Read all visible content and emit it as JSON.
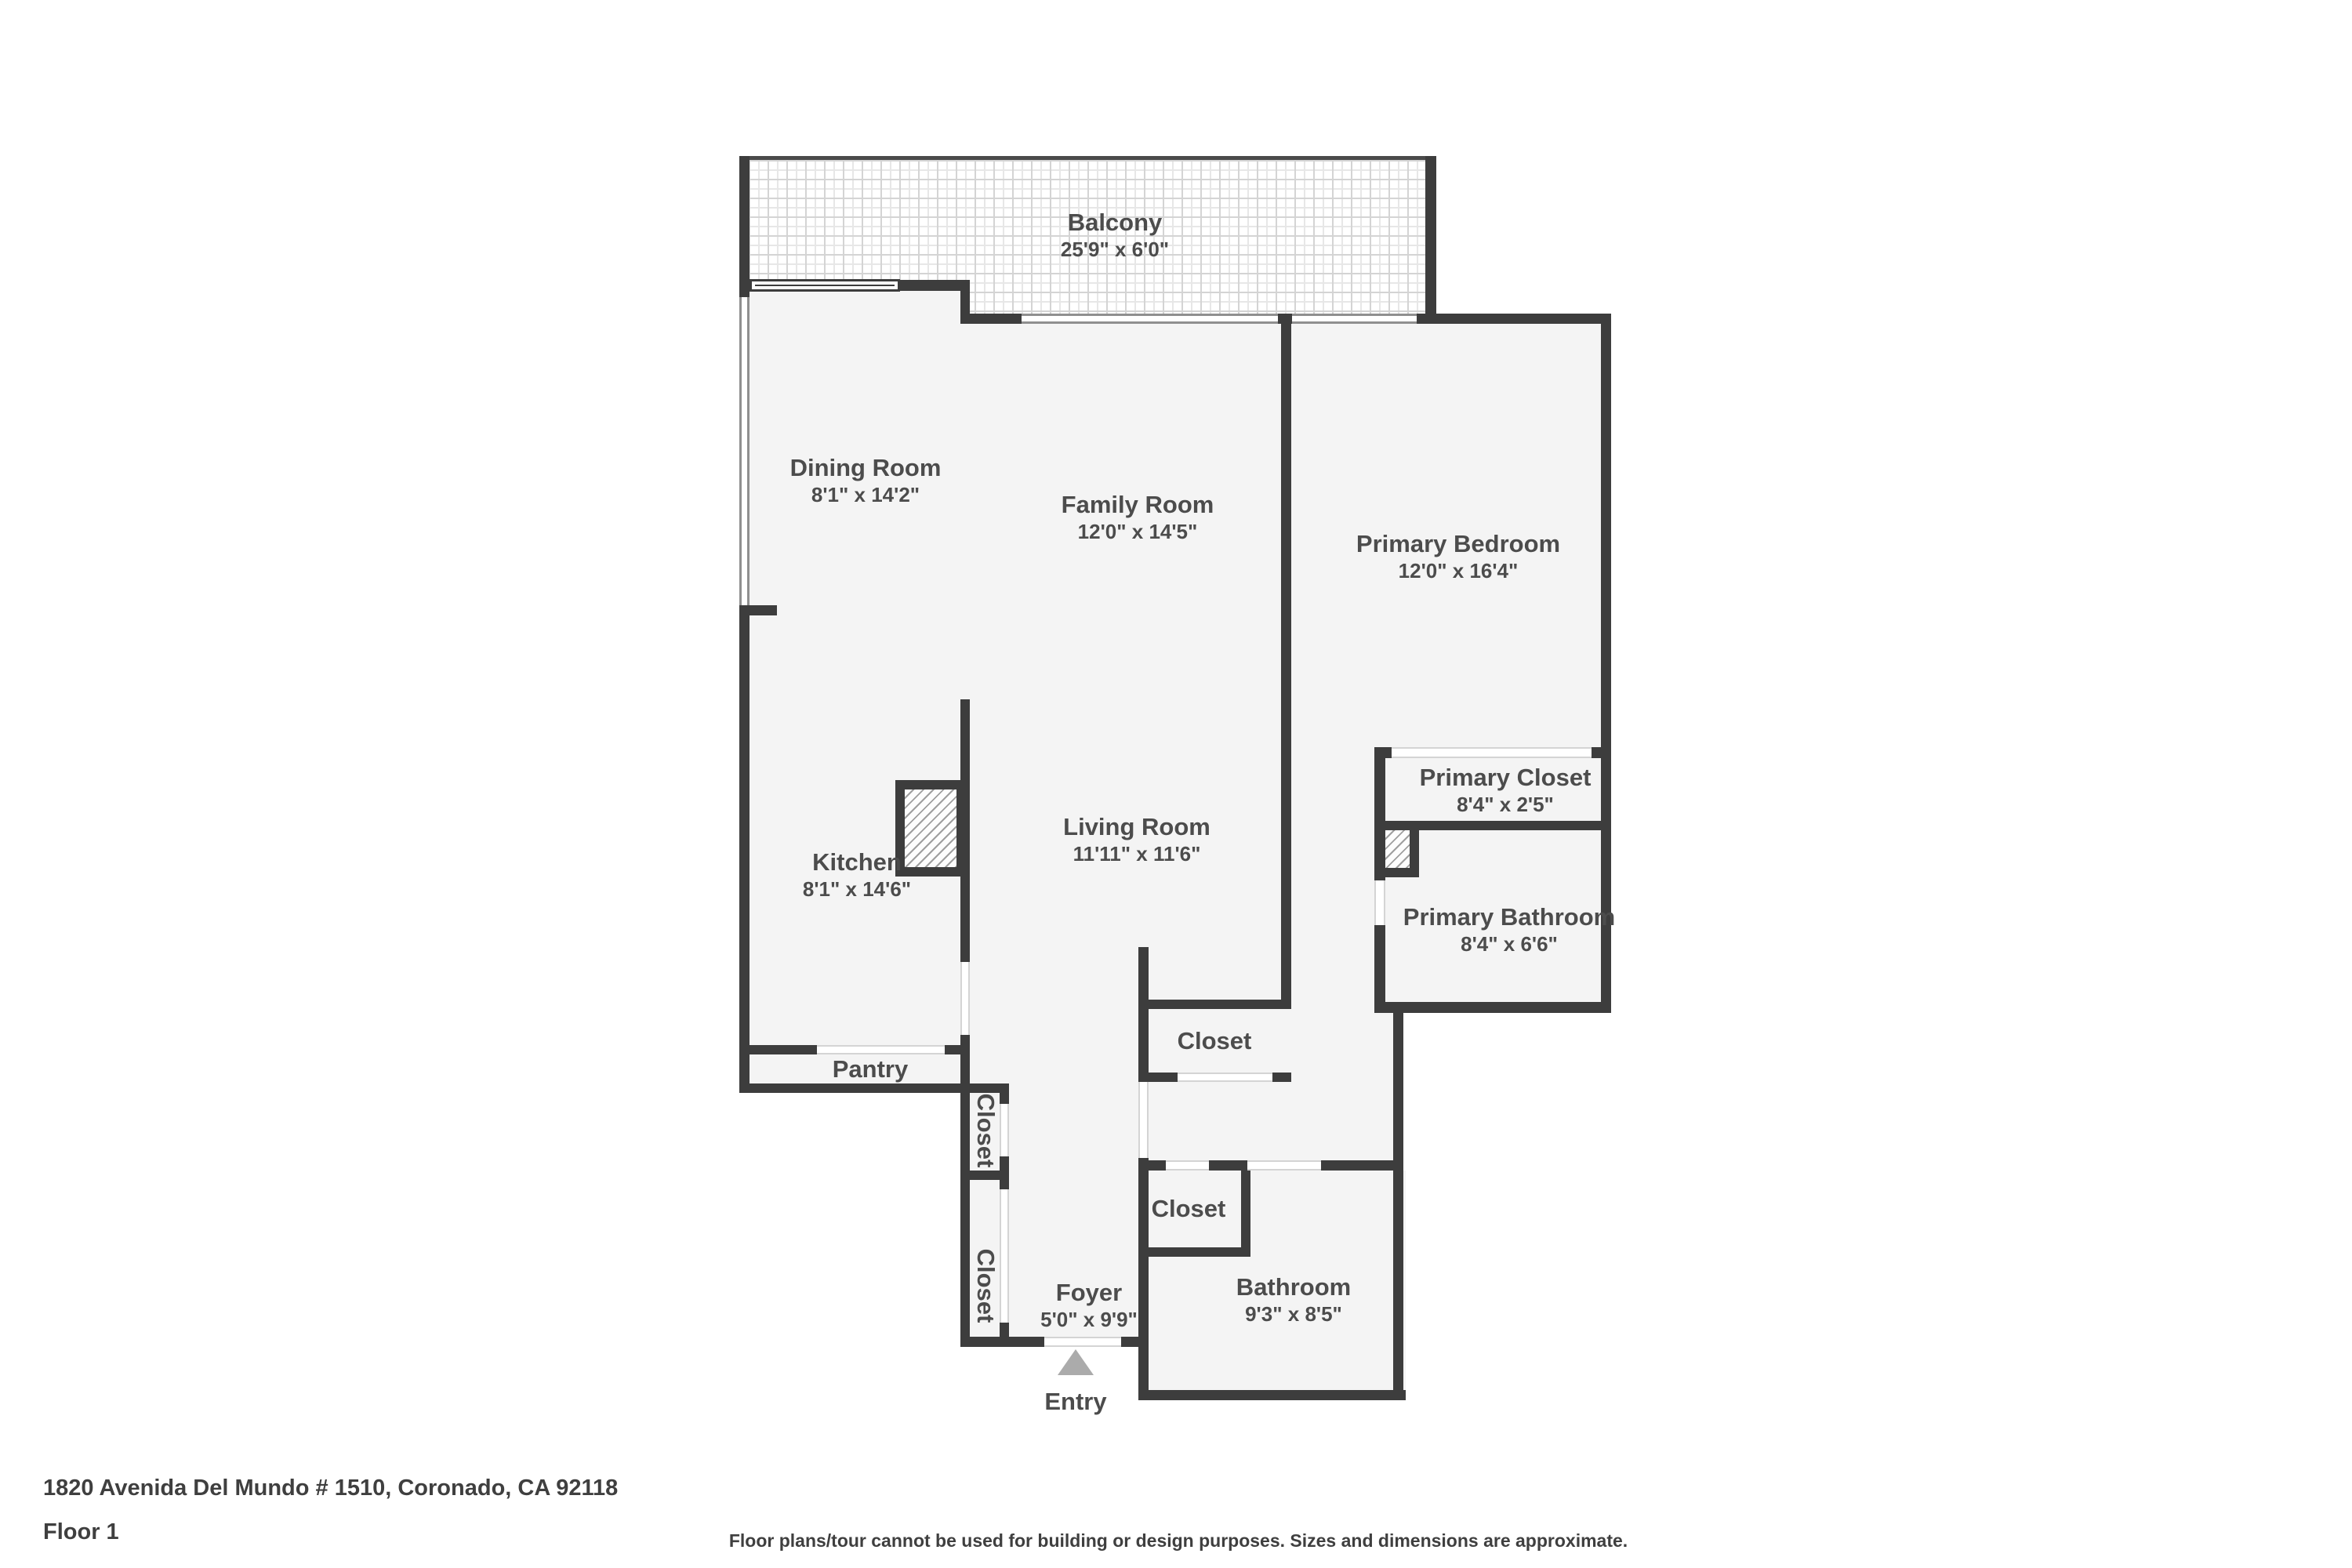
{
  "plan": {
    "rooms": {
      "balcony": {
        "name": "Balcony",
        "dims": "25'9\" x 6'0\""
      },
      "dining_room": {
        "name": "Dining Room",
        "dims": "8'1\" x 14'2\""
      },
      "family_room": {
        "name": "Family Room",
        "dims": "12'0\" x 14'5\""
      },
      "primary_bedroom": {
        "name": "Primary Bedroom",
        "dims": "12'0\" x 16'4\""
      },
      "kitchen": {
        "name": "Kitchen",
        "dims": "8'1\" x 14'6\""
      },
      "living_room": {
        "name": "Living Room",
        "dims": "11'11\" x 11'6\""
      },
      "primary_closet": {
        "name": "Primary Closet",
        "dims": "8'4\" x 2'5\""
      },
      "primary_bathroom": {
        "name": "Primary Bathroom",
        "dims": "8'4\" x 6'6\""
      },
      "pantry": {
        "name": "Pantry"
      },
      "hall_closet": {
        "name": "Closet"
      },
      "bathroom_closet": {
        "name": "Closet"
      },
      "foyer_closet_upper": {
        "name": "Closet"
      },
      "foyer_closet_lower": {
        "name": "Closet"
      },
      "foyer": {
        "name": "Foyer",
        "dims": "5'0\" x 9'9\""
      },
      "bathroom": {
        "name": "Bathroom",
        "dims": "9'3\" x 8'5\""
      }
    },
    "entry_label": "Entry"
  },
  "footer": {
    "address": "1820 Avenida Del Mundo # 1510, Coronado, CA 92118",
    "floor": "Floor 1",
    "disclaimer": "Floor plans/tour cannot be used for building or design purposes. Sizes and dimensions are approximate."
  },
  "colors": {
    "wall": "#3d3d3d",
    "floor_fill": "#f4f4f4",
    "label_text": "#4c4c4c",
    "entry_arrow": "#ababab",
    "balcony_tile_line": "#d4d4d4",
    "hatch_line": "#9f9f9f"
  }
}
